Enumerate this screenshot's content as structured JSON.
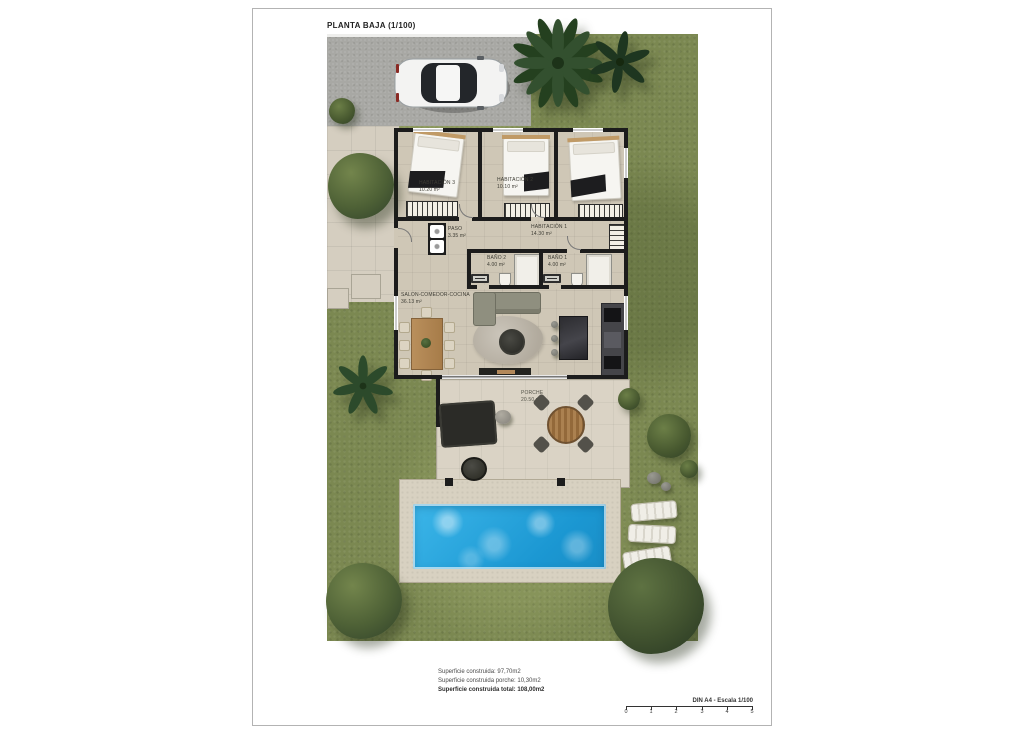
{
  "page": {
    "title": "PLANTA BAJA (1/100)"
  },
  "rooms": {
    "hab3": {
      "label": "HABITACIÓN 3",
      "area": "10.20 m²"
    },
    "hab2": {
      "label": "HABITACIÓN 2",
      "area": "10.10 m²"
    },
    "hab1": {
      "label": "HABITACIÓN 1",
      "area": "14.30 m²"
    },
    "paso": {
      "label": "PASO",
      "area": "3.35 m²"
    },
    "bano2": {
      "label": "BAÑO 2",
      "area": "4.00 m²"
    },
    "bano1": {
      "label": "BAÑO 1",
      "area": "4.00 m²"
    },
    "salon": {
      "label": "SALON-COMEDOR-COCINA",
      "area": "36.13 m²"
    },
    "porche": {
      "label": "PORCHE",
      "area": "20.50 m²"
    }
  },
  "summary": {
    "construida": "Superficie construida: 97,70m2",
    "porche": "Superficie construida porche: 10,30m2",
    "total": "Superficie construida total: 108,00m2"
  },
  "scalebar": {
    "label": "DIN A4 - Escala 1/100",
    "ticks": [
      "0",
      "1",
      "2",
      "3",
      "4",
      "5"
    ]
  },
  "colors": {
    "pool": "#2aa9e2",
    "grass": "#7b8851",
    "wall": "#1c1c1c",
    "floor": "#cfc7b6",
    "driveway": "#a8a8a4"
  }
}
